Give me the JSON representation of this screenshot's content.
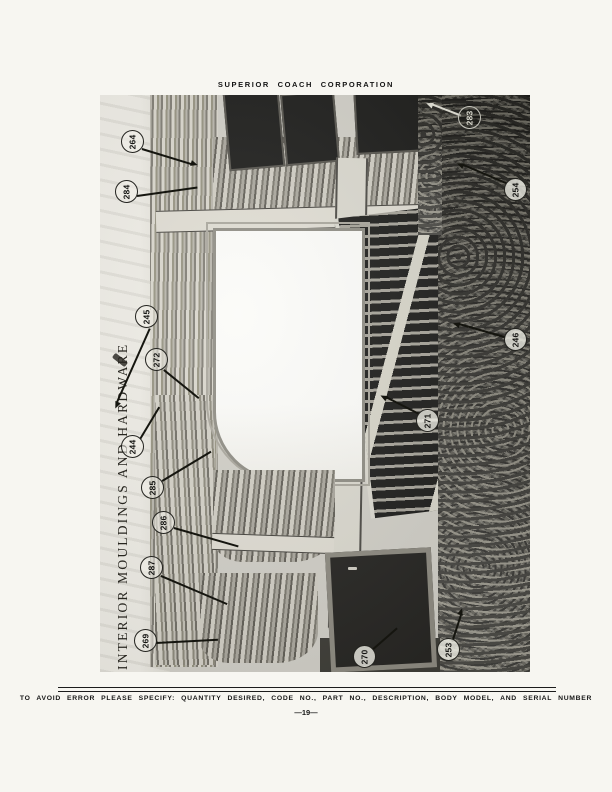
{
  "page": {
    "header_title": "SUPERIOR COACH CORPORATION",
    "footer_note": "TO AVOID ERROR PLEASE SPECIFY: QUANTITY DESIRED, CODE NO., PART NO., DESCRIPTION, BODY MODEL, AND SERIAL NUMBER",
    "page_number": "—19—"
  },
  "figure": {
    "title": "INTERIOR MOULDINGS AND HARDWARE",
    "callouts": [
      {
        "number": "264"
      },
      {
        "number": "284"
      },
      {
        "number": "245"
      },
      {
        "number": "272"
      },
      {
        "number": "244"
      },
      {
        "number": "285"
      },
      {
        "number": "286"
      },
      {
        "number": "287"
      },
      {
        "number": "269"
      },
      {
        "number": "283"
      },
      {
        "number": "254"
      },
      {
        "number": "246"
      },
      {
        "number": "271"
      },
      {
        "number": "270"
      },
      {
        "number": "253"
      }
    ]
  }
}
